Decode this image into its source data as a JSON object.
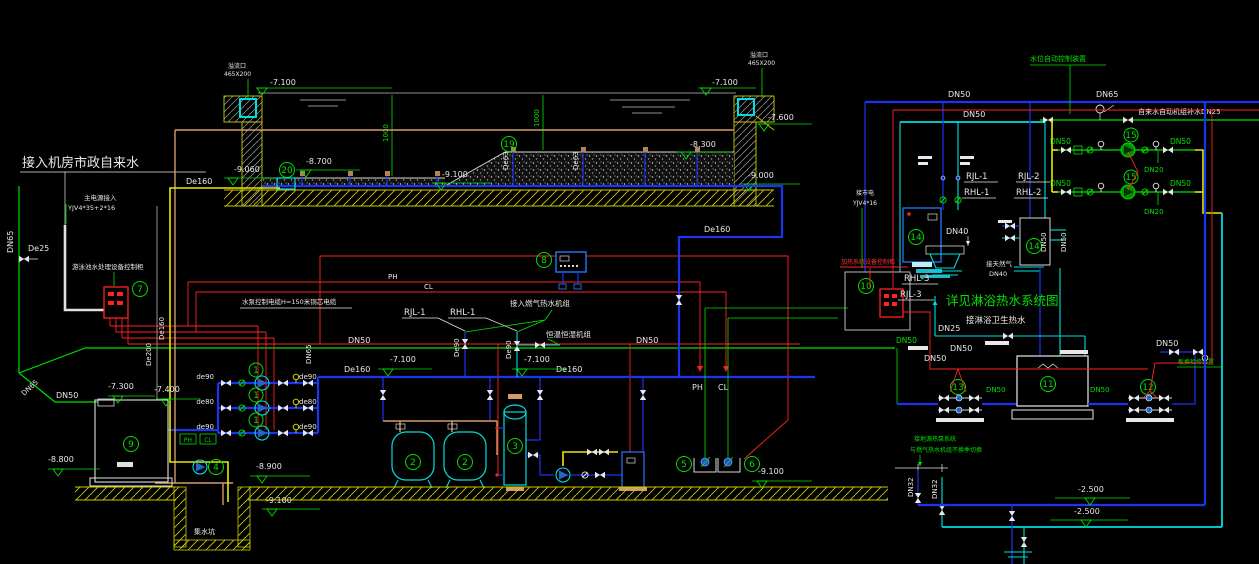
{
  "t": {
    "title": "接入机房市政自来水",
    "power1": "主电源接入",
    "power2": "YJV4*35+2*16",
    "gridpower": "接市电",
    "gridpower2": "YJV4*16",
    "de25": "De25",
    "dn65": "DN65",
    "dn50": "DN50",
    "dn40": "DN40",
    "dn32": "DN32",
    "dn25": "DN25",
    "dn20": "DN20",
    "de160": "De160",
    "de200": "De200",
    "de90": "De90",
    "de90s": "de90",
    "de80s": "de80",
    "de63": "De63",
    "dim1000": "1000",
    "pool_cab": "游泳池水处理设备控制柜",
    "heat_cab": "加热系统设备控制柜",
    "cable": "水泵控制电缆H=150米铜芯电缆",
    "gas_unit": "接入燃气热水机组",
    "hvac": "恒温恒湿机组",
    "ph": "PH",
    "cl": "CL",
    "rjl1": "RJL-1",
    "rhl1": "RHL-1",
    "rjl2": "RJL-2",
    "rhl2": "RHL-2",
    "rjl3": "RJL-3",
    "rhl3": "RHL-3",
    "see": "详见淋浴热水系统图",
    "shower": "接淋浴卫生热水",
    "gas": "接天然气",
    "makeup": "自来水自动机组补水DN25",
    "level": "水位自动控制装置",
    "service": "板换检修装置",
    "ghp1": "接地源热泵系统",
    "ghp2": "与燃气热水机组不换季切换",
    "sump": "集水坑",
    "ovf1": "溢流口",
    "ovf2": "465X200"
  },
  "e": {
    "e71": "-7.100",
    "e76": "-7.600",
    "e83": "-8.300",
    "e87": "-8.700",
    "e90": "-9.000",
    "e906": "-9.060",
    "e91": "-9.100",
    "e88": "-8.800",
    "e89": "-8.900",
    "e73": "-7.300",
    "e74": "-7.400",
    "e25": "-2.500"
  },
  "b": {
    "n1": "1",
    "n2": "2",
    "n3": "3",
    "n4": "4",
    "n5": "5",
    "n6": "6",
    "n7": "7",
    "n8": "8",
    "n9": "9",
    "n10": "10",
    "n11": "11",
    "n12": "12",
    "n13": "13",
    "n14": "14",
    "n15": "15",
    "n19": "19",
    "n20": "20"
  },
  "colors": {
    "background": "#000000",
    "pipe_blue": "#1a35f0",
    "pipe_cyan": "#00dede",
    "line_green": "#00e100",
    "wire_red": "#ff2222",
    "pipe_yellow": "#e8e800",
    "pipe_tan": "#d49a6a",
    "text_white": "#e8e8e8"
  }
}
